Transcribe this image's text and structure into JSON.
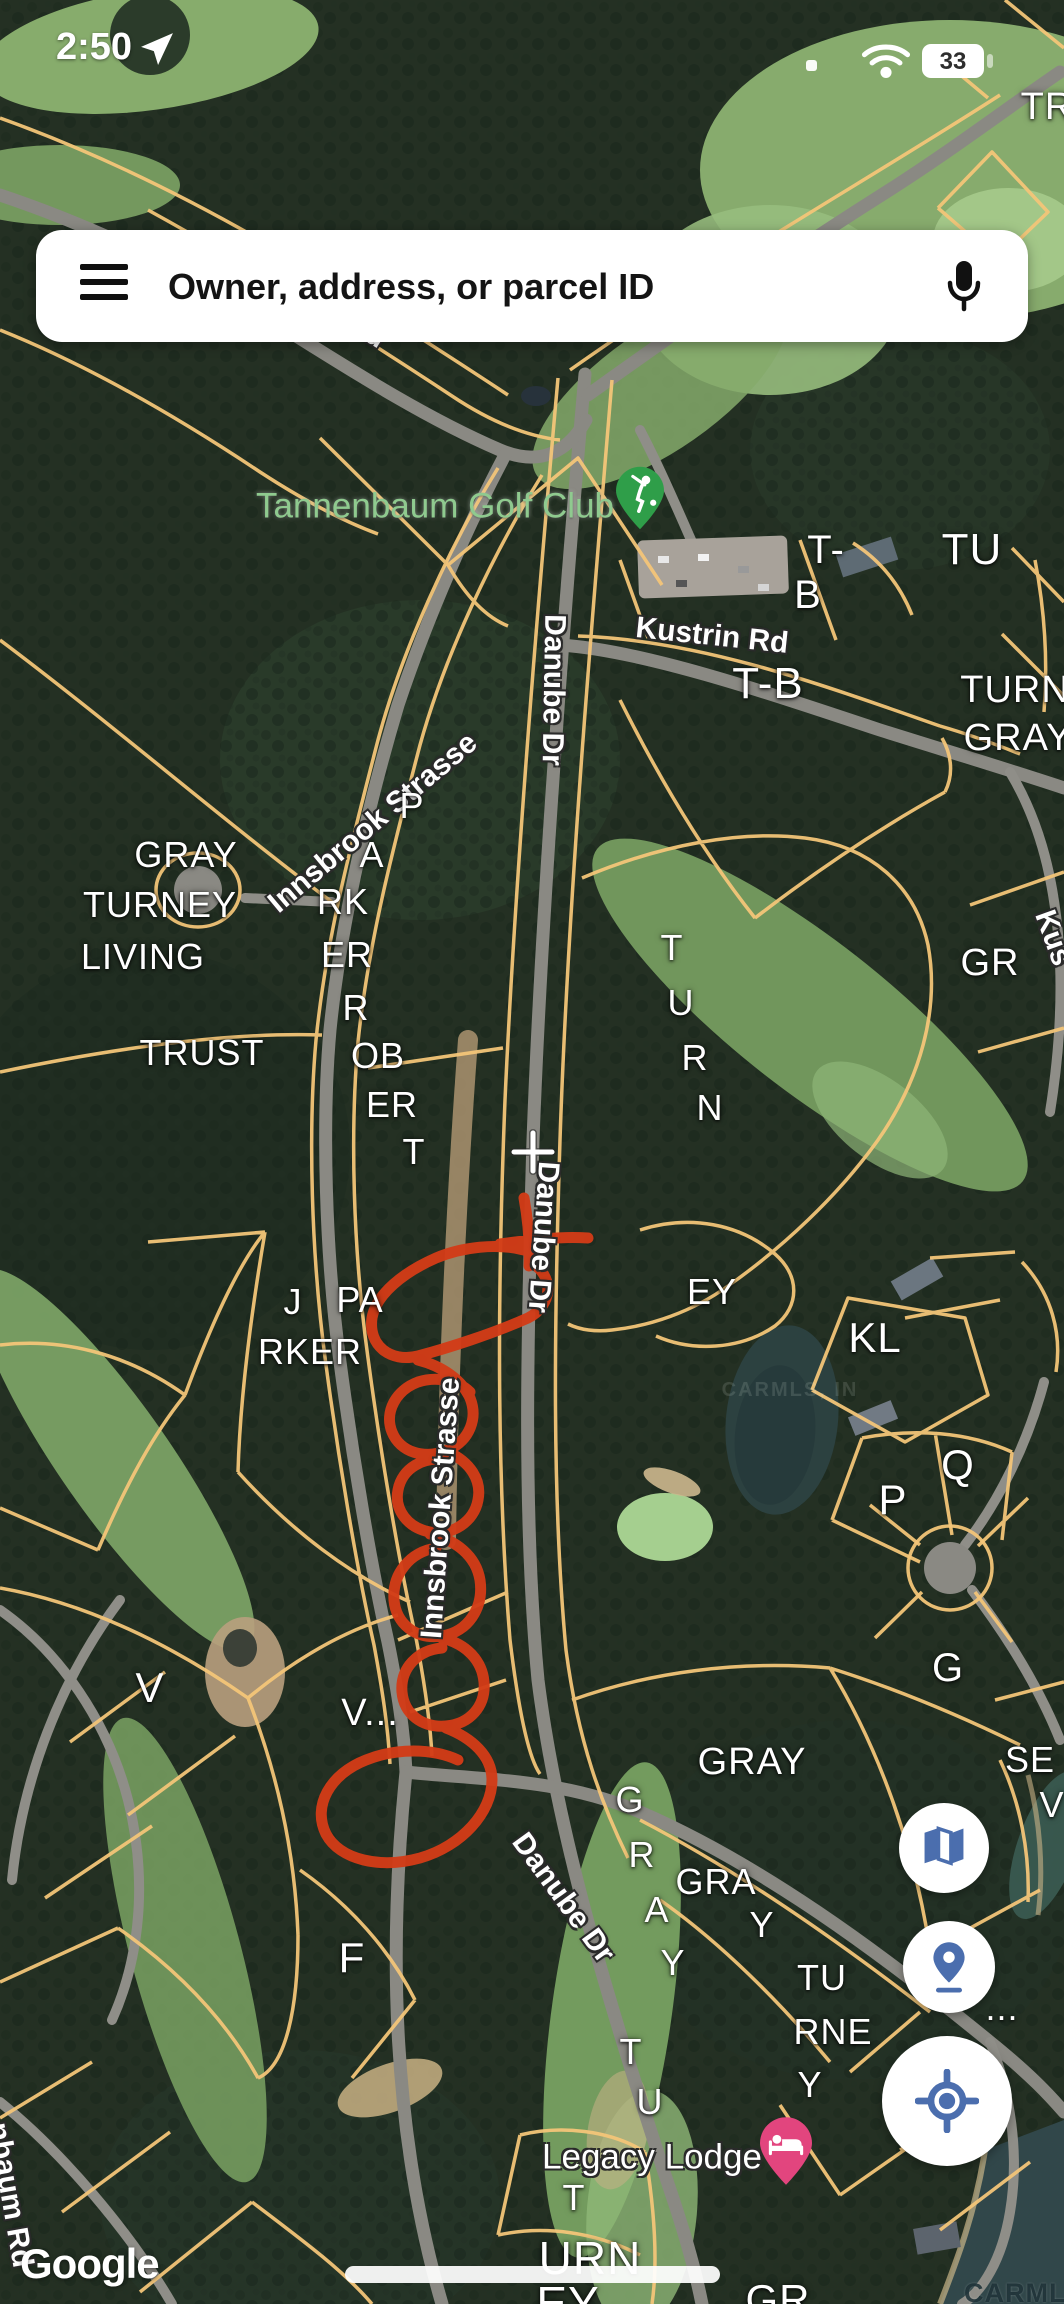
{
  "status_bar": {
    "time": "2:50",
    "battery": "33"
  },
  "search_bar": {
    "placeholder": "Owner, address, or parcel ID"
  },
  "colors": {
    "parcel_line": "#f3c578",
    "annotation_red": "#d23b17",
    "icon_blue": "#4b6eae",
    "golf_pin_green": "#2f9e49",
    "lodging_pin_pink": "#e2457e",
    "poi_label_green": "#8fca8f"
  },
  "map": {
    "attribution": "Google",
    "watermark": "CARMLS, INC",
    "lake_watermark": "CARMLS, IN",
    "poi_labels": [
      {
        "text": "Tannenbaum Golf Club",
        "x": 435,
        "y": 506,
        "size": 35,
        "cls": "poi-green",
        "name": "golf-club-label"
      },
      {
        "text": "Legacy Lodge",
        "x": 652,
        "y": 2157,
        "size": 35,
        "cls": "poi-white",
        "name": "legacy-lodge-label"
      }
    ],
    "road_labels": [
      {
        "text": "nenbaum Rd",
        "x": 307,
        "y": 292,
        "rot": 33
      },
      {
        "text": "Kustrin Rd",
        "x": 712,
        "y": 636,
        "rot": 6
      },
      {
        "text": "Danube Dr",
        "x": 553,
        "y": 690,
        "rot": 91
      },
      {
        "text": "Danube Dr",
        "x": 543,
        "y": 1237,
        "rot": 94
      },
      {
        "text": "Danube Dr",
        "x": 563,
        "y": 1898,
        "rot": 54
      },
      {
        "text": "Innsbrook Strasse",
        "x": 373,
        "y": 823,
        "rot": -40
      },
      {
        "text": "Innsbrook Strasse",
        "x": 441,
        "y": 1508,
        "rot": -86
      },
      {
        "text": "Kus",
        "x": 1053,
        "y": 938,
        "rot": 70
      },
      {
        "text": "nbaum Rd",
        "x": 10,
        "y": 2195,
        "rot": 80
      }
    ],
    "parcel_labels": [
      {
        "text": "TR",
        "x": 1047,
        "y": 107,
        "size": 38
      },
      {
        "text": "T-",
        "x": 826,
        "y": 550,
        "size": 40
      },
      {
        "text": "B",
        "x": 808,
        "y": 595,
        "size": 40
      },
      {
        "text": "TU",
        "x": 972,
        "y": 550,
        "size": 44
      },
      {
        "text": "T-B",
        "x": 768,
        "y": 684,
        "size": 44
      },
      {
        "text": "TURN",
        "x": 1015,
        "y": 690,
        "size": 38
      },
      {
        "text": "GRAY",
        "x": 1018,
        "y": 738,
        "size": 38
      },
      {
        "text": "GRAY",
        "x": 186,
        "y": 855
      },
      {
        "text": "TURNEY",
        "x": 160,
        "y": 905
      },
      {
        "text": "LIVING",
        "x": 143,
        "y": 957
      },
      {
        "text": "TRUST",
        "x": 202,
        "y": 1053
      },
      {
        "text": "P",
        "x": 412,
        "y": 806
      },
      {
        "text": "A",
        "x": 372,
        "y": 855
      },
      {
        "text": "RK",
        "x": 343,
        "y": 902
      },
      {
        "text": "ER",
        "x": 347,
        "y": 955
      },
      {
        "text": "R",
        "x": 356,
        "y": 1008
      },
      {
        "text": "OB",
        "x": 378,
        "y": 1056
      },
      {
        "text": "ER",
        "x": 392,
        "y": 1105
      },
      {
        "text": "T",
        "x": 414,
        "y": 1152
      },
      {
        "text": "GR",
        "x": 990,
        "y": 963,
        "size": 38
      },
      {
        "text": "T",
        "x": 672,
        "y": 948
      },
      {
        "text": "U",
        "x": 681,
        "y": 1003
      },
      {
        "text": "R",
        "x": 695,
        "y": 1058
      },
      {
        "text": "N",
        "x": 710,
        "y": 1108
      },
      {
        "text": "EY",
        "x": 712,
        "y": 1292
      },
      {
        "text": "J",
        "x": 293,
        "y": 1302
      },
      {
        "text": "PA",
        "x": 360,
        "y": 1300
      },
      {
        "text": "RKER",
        "x": 310,
        "y": 1352
      },
      {
        "text": "KL",
        "x": 875,
        "y": 1338,
        "size": 42
      },
      {
        "text": "Q",
        "x": 958,
        "y": 1465,
        "size": 42
      },
      {
        "text": "P",
        "x": 893,
        "y": 1500,
        "size": 42
      },
      {
        "text": "G",
        "x": 948,
        "y": 1668,
        "size": 40
      },
      {
        "text": "V",
        "x": 150,
        "y": 1688,
        "size": 42
      },
      {
        "text": "V...",
        "x": 370,
        "y": 1713,
        "size": 38
      },
      {
        "text": "GRAY",
        "x": 752,
        "y": 1762,
        "size": 38
      },
      {
        "text": "SE",
        "x": 1030,
        "y": 1760
      },
      {
        "text": "V",
        "x": 1052,
        "y": 1805
      },
      {
        "text": "G",
        "x": 630,
        "y": 1800
      },
      {
        "text": "R",
        "x": 642,
        "y": 1855
      },
      {
        "text": "A",
        "x": 657,
        "y": 1910
      },
      {
        "text": "Y",
        "x": 673,
        "y": 1963
      },
      {
        "text": "GRA",
        "x": 716,
        "y": 1882
      },
      {
        "text": "Y",
        "x": 762,
        "y": 1925
      },
      {
        "text": "F",
        "x": 352,
        "y": 1958,
        "size": 42
      },
      {
        "text": "TU",
        "x": 822,
        "y": 1978
      },
      {
        "text": "RNE",
        "x": 833,
        "y": 2032
      },
      {
        "text": "Y",
        "x": 810,
        "y": 2085
      },
      {
        "text": "T",
        "x": 631,
        "y": 2052
      },
      {
        "text": "U",
        "x": 650,
        "y": 2102
      },
      {
        "text": "T",
        "x": 574,
        "y": 2198
      },
      {
        "text": "URN",
        "x": 590,
        "y": 2258,
        "size": 46
      },
      {
        "text": "EY",
        "x": 568,
        "y": 2303,
        "size": 46
      },
      {
        "text": "GR",
        "x": 778,
        "y": 2300,
        "size": 42
      },
      {
        "text": "...",
        "x": 1002,
        "y": 2008
      }
    ]
  },
  "fab_buttons": [
    {
      "name": "map-layers-button"
    },
    {
      "name": "location-pin-button"
    },
    {
      "name": "my-location-button"
    }
  ]
}
